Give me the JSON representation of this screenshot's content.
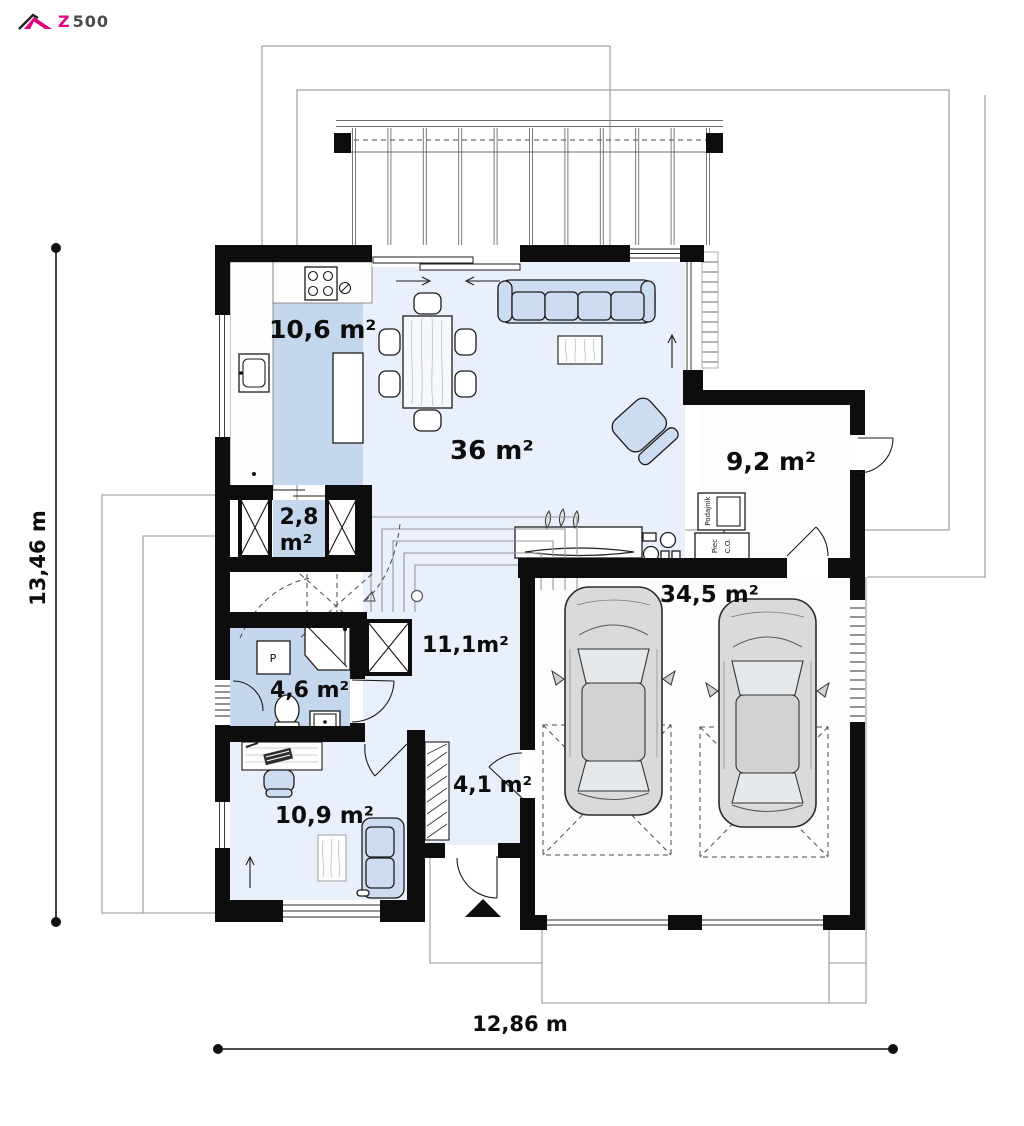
{
  "logo": {
    "brand": "Z500",
    "brand_z": "Z",
    "brand_digits": "500",
    "accent_color": "#e5017f"
  },
  "plan_type": "ground-floor-plan",
  "rooms": {
    "kitchen": {
      "area_label": "10,6 m²"
    },
    "living_dining": {
      "area_label": "36 m²"
    },
    "boiler_room": {
      "area_label": "9,2 m²"
    },
    "pantry": {
      "area_label": "2,8 m²",
      "area_line1": "2,8",
      "area_line2": "m²"
    },
    "hall": {
      "area_label": "11,1m²"
    },
    "bathroom": {
      "area_label": "4,6 m²"
    },
    "garage": {
      "area_label": "34,5 m²"
    },
    "entry": {
      "area_label": "4,1 m²"
    },
    "office": {
      "area_label": "10,9 m²"
    }
  },
  "equipment": {
    "feeder_label": "Podajnik",
    "furnace_label": "Piec C.O.",
    "furnace_line1": "Piec",
    "furnace_line2": "C.O.",
    "washer_label": "P"
  },
  "dimensions": {
    "width_label": "12,86 m",
    "height_label": "13,46 m"
  },
  "colors": {
    "wall": "#0d0d0d",
    "room_blue": "#c4d7ec",
    "room_light": "#e9effb",
    "room_white": "#fcfdff",
    "furniture_blue": "#cddcf1",
    "outline_gray": "#97979b",
    "brand_magenta": "#e5017f"
  }
}
